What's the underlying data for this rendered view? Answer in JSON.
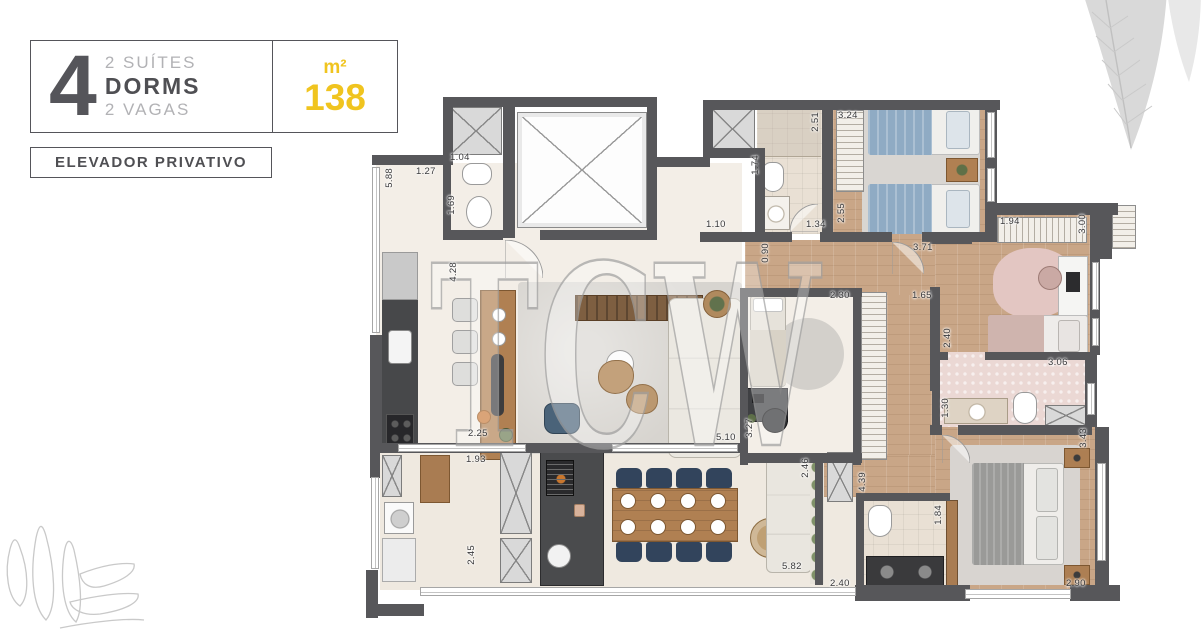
{
  "header": {
    "number": "4",
    "suites": "2 SUÍTES",
    "dorms": "DORMS",
    "vagas": "2 VAGAS",
    "area_unit": "m²",
    "area_value": "138",
    "private_elevator": "ELEVADOR PRIVATIVO"
  },
  "watermark": {
    "text": "TCW"
  },
  "colors": {
    "accent_yellow": "#f0c41f",
    "wall_gray": "#57575a",
    "text_dark": "#4f4f53",
    "text_light": "#b2b2b5"
  },
  "plan": {
    "dims": [
      "5.88",
      "1.27",
      "1.04",
      "1.69",
      "4.28",
      "1.74",
      "2.51",
      "3.24",
      "1.10",
      "1.34",
      "2.55",
      "0.90",
      "3.71",
      "1.94",
      "3.00",
      "2.30",
      "1.65",
      "2.40",
      "3.06",
      "1.30",
      "3.43",
      "5.10",
      "3.27",
      "2.25",
      "1.93",
      "2.45",
      "5.82",
      "2.46",
      "4.39",
      "2.40",
      "1.84",
      "2.90"
    ]
  }
}
